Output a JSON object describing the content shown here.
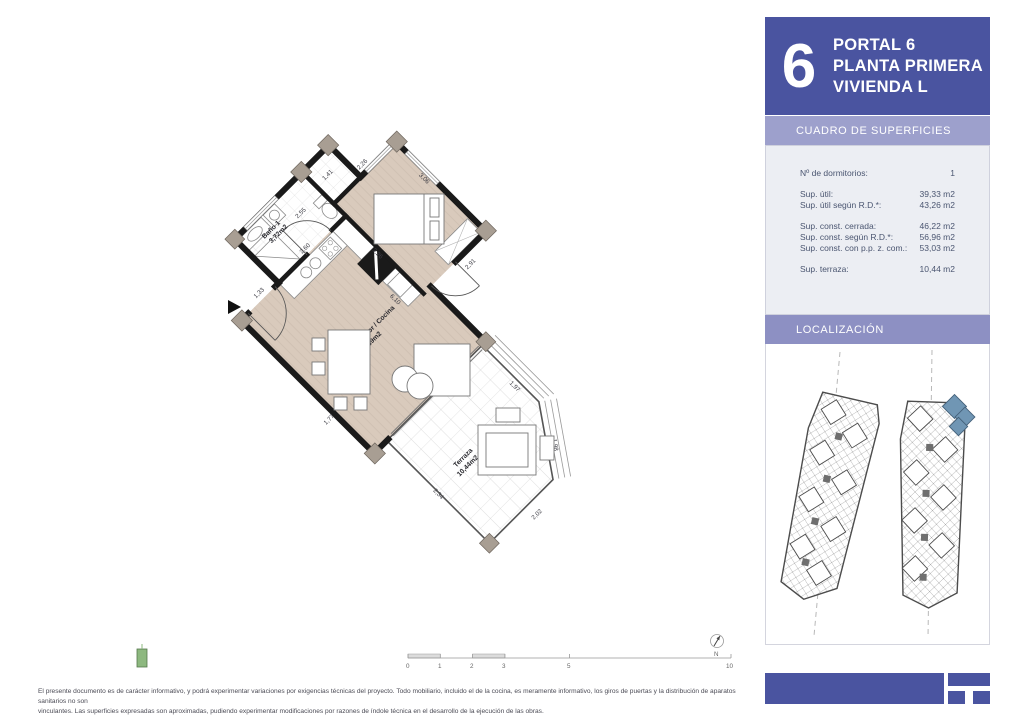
{
  "header": {
    "big_number": "6",
    "lines": [
      "PORTAL 6",
      "PLANTA PRIMERA",
      "VIVIENDA L"
    ]
  },
  "surfaces": {
    "title": "CUADRO DE SUPERFICIES",
    "rows": [
      {
        "label": "Nº de dormitorios:",
        "value": "1"
      },
      {
        "label": "Sup. útil:",
        "value": "39,33 m2"
      },
      {
        "label": "Sup. útil según R.D.*:",
        "value": "43,26 m2"
      },
      {
        "label": "Sup. const. cerrada:",
        "value": "46,22 m2"
      },
      {
        "label": "Sup. const. según R.D.*:",
        "value": "56,96 m2"
      },
      {
        "label": "Sup. const. con p.p. z. com.:",
        "value": "53,03 m2"
      },
      {
        "label": "Sup. terraza:",
        "value": "10,44 m2"
      }
    ]
  },
  "location": {
    "title": "LOCALIZACIÓN"
  },
  "plan": {
    "rooms": [
      {
        "name": "Baño 1",
        "area": "3,72m2"
      },
      {
        "name": "Dormitorio 1",
        "area": "11,02m2"
      },
      {
        "name": "Salón / Comedor / Cocina",
        "area": "24,59m2"
      },
      {
        "name": "Terraza",
        "area": "10,44m2"
      }
    ],
    "dims": {
      "d0": "2,26",
      "d1": "3,06",
      "d2": "2,91",
      "d3": "3,26",
      "d4": "1,41",
      "d5": "2,55",
      "d6": "2,60",
      "d7": "1,33",
      "d8": "1,77",
      "d9": "6,10",
      "d10": "3,46",
      "d11": "3,42",
      "d12": "1,97",
      "d13": "1,98",
      "d14": "2,02",
      "d15": "2,34"
    },
    "north_label": "N",
    "scale_ticks": [
      "0",
      "1",
      "2",
      "3",
      "5",
      "10"
    ]
  },
  "footer": {
    "disclaimer_line1": "El presente documento es de carácter informativo, y podrá experimentar variaciones por exigencias técnicas del proyecto. Todo mobiliario, incluido el de la cocina, es meramente informativo, los giros de puertas y la distribución de aparatos sanitarios no son",
    "disclaimer_line2": "vinculantes. Las superficies expresadas son aproximadas, pudiendo experimentar modificaciones por razones de índole técnica en el desarrollo de la ejecución de las obras."
  },
  "colors": {
    "header_bg": "#4a54a0",
    "band_light": "#9da0cc",
    "band_mid": "#8d90c3",
    "panel_bg": "#eceef3",
    "highlight_unit": "#7096b4",
    "wall": "#1a1a1a",
    "floor": "#d9cabc",
    "column": "#a89e93"
  }
}
